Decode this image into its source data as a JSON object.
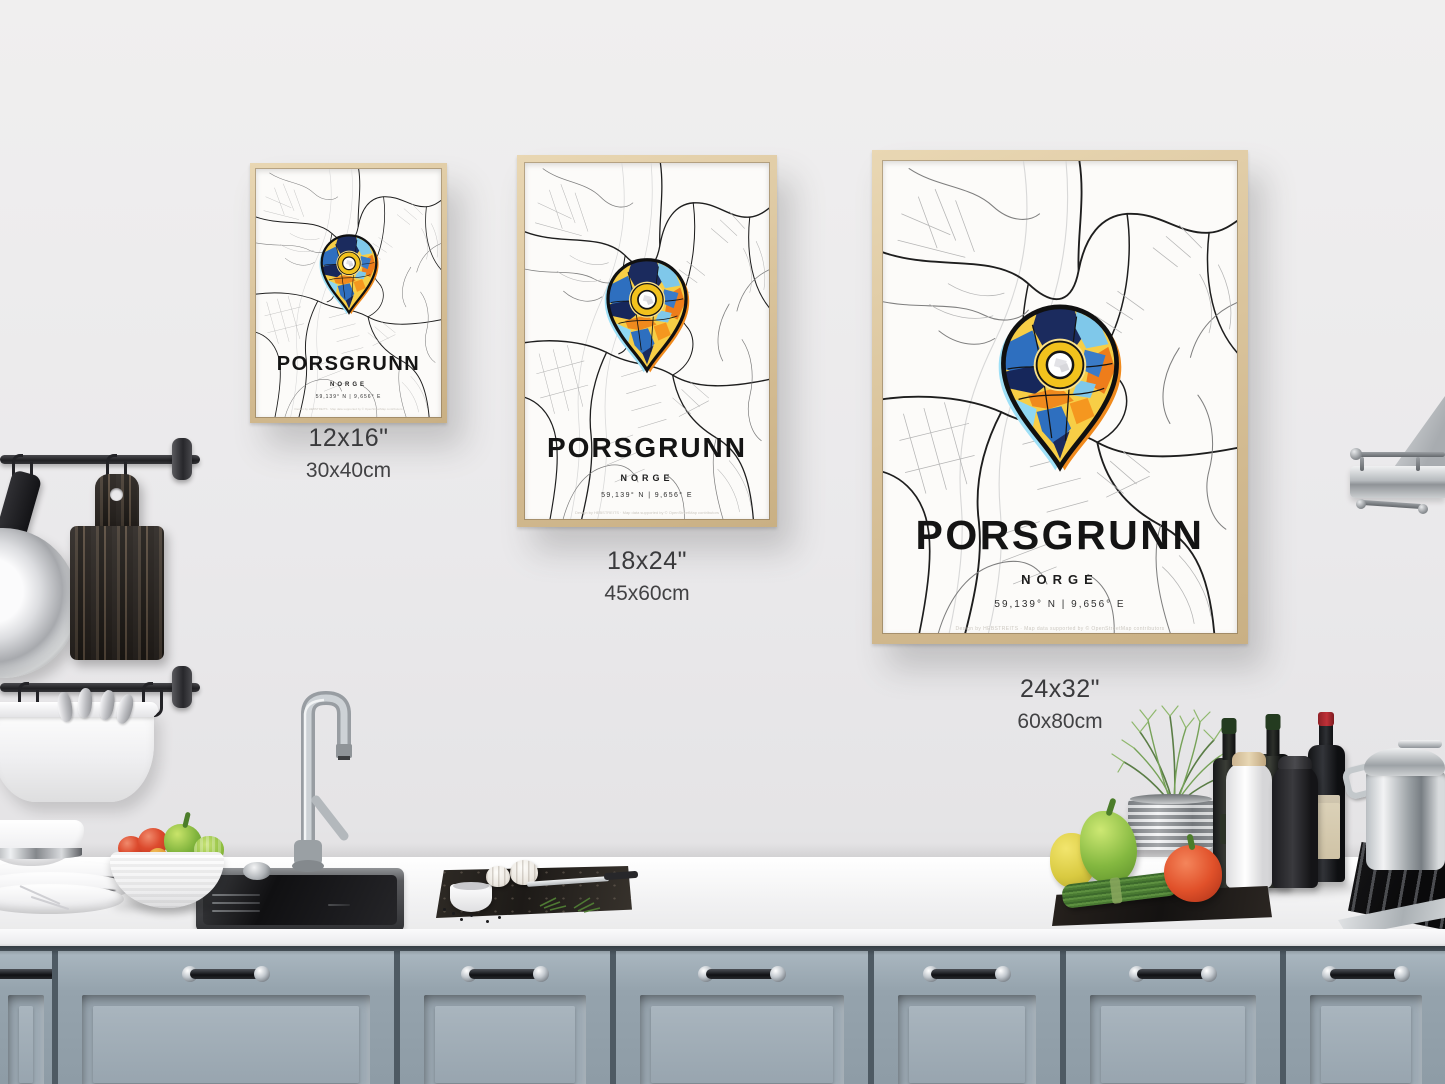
{
  "posters": {
    "title": "PORSGRUNN",
    "country": "NORGE",
    "coordinates": "59,139° N | 9,656° E",
    "attribution": "Design by HEBSTREITS · Map data supported by © OpenStreetMap contributors",
    "items": [
      {
        "name": "small",
        "inches": "12x16\"",
        "centimeters": "30x40cm"
      },
      {
        "name": "medium",
        "inches": "18x24\"",
        "centimeters": "45x60cm"
      },
      {
        "name": "large",
        "inches": "24x32\"",
        "centimeters": "60x80cm"
      }
    ]
  },
  "palette": {
    "pin_navy": "#1b2b5e",
    "pin_blue": "#2e6fbf",
    "pin_lightblue": "#7fc8ea",
    "pin_yellow": "#f7ce46",
    "pin_orange": "#ef7f1a",
    "frame_wood": "#d9c29c",
    "cabinet_blue_gray": "#97a5b0",
    "wall_gray": "#e9e8ea"
  }
}
